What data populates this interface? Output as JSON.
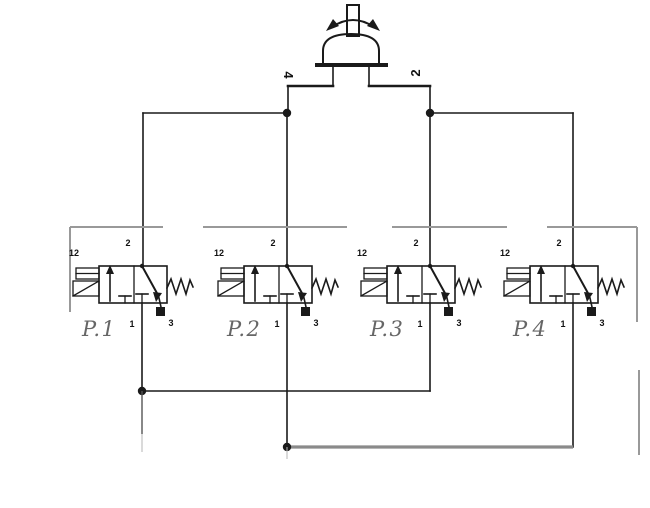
{
  "diagram": {
    "type": "pneumatic-circuit-schematic",
    "selector": {
      "left_port_label": "4",
      "right_port_label": "2"
    },
    "port_labels": {
      "pilot": "12",
      "output": "2",
      "supply": "1",
      "exhaust": "3"
    },
    "valves": [
      {
        "name": "P.1"
      },
      {
        "name": "P.2"
      },
      {
        "name": "P.3"
      },
      {
        "name": "P.4"
      }
    ],
    "colors": {
      "line": "#1a1a1a",
      "frame_dashed": "#999999",
      "bottom_bus": "#8a8a8a",
      "valve_label": "#666666",
      "background": "#ffffff"
    }
  }
}
